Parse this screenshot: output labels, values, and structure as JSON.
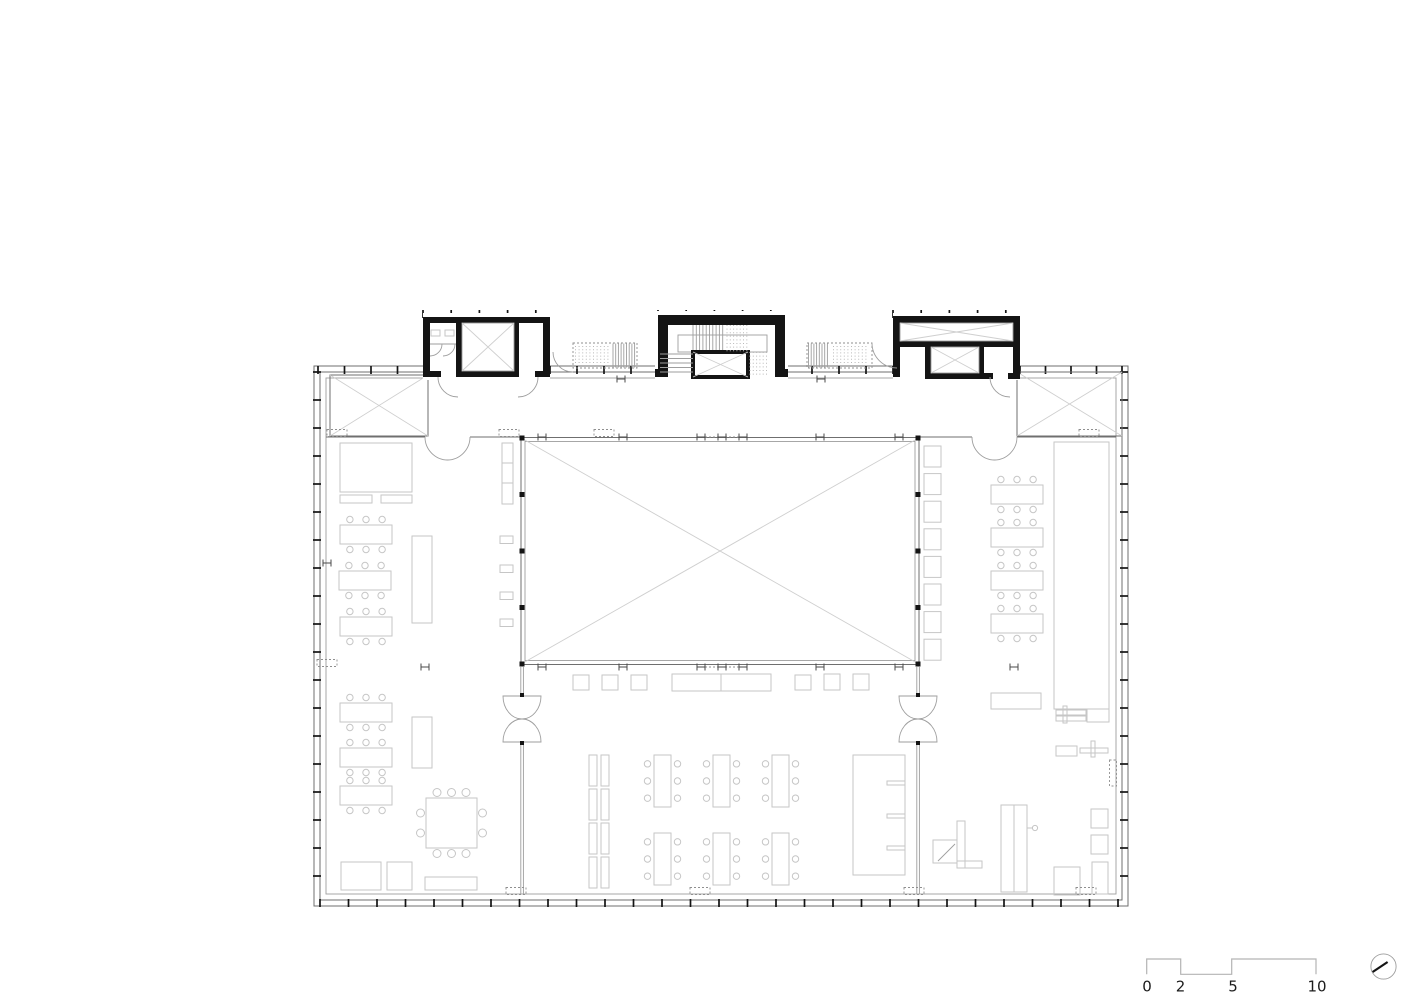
{
  "drawing": {
    "kind": "architectural floor plan",
    "colors": {
      "black": "#141414",
      "wall_line": "#6f6f6f",
      "thin_line": "#9e9e9e",
      "furniture_line": "#c6c6c6",
      "scale_bar_line": "#b4b4b4",
      "text": "#1c1c1c",
      "background": "#ffffff"
    }
  },
  "scale_bar": {
    "labels": [
      "0",
      "2",
      "5",
      "10"
    ]
  },
  "north_arrow": {
    "icon": "north-arrow-icon"
  },
  "plan": {
    "ticks": [
      {
        "axis": "x",
        "at": 314,
        "from": 423,
        "to": 550,
        "step": 28.2
      },
      {
        "axis": "x",
        "at": 314,
        "from": 658,
        "to": 785,
        "step": 28.2
      },
      {
        "axis": "x",
        "at": 314,
        "from": 893,
        "to": 1020,
        "step": 28.2
      },
      {
        "axis": "x",
        "at": 370,
        "from": 318,
        "to": 423,
        "step": 26.5
      },
      {
        "axis": "x",
        "at": 370,
        "from": 550,
        "to": 658,
        "step": 27
      },
      {
        "axis": "x",
        "at": 370,
        "from": 785,
        "to": 893,
        "step": 27
      },
      {
        "axis": "x",
        "at": 370,
        "from": 1020,
        "to": 1122,
        "step": 25.5
      },
      {
        "axis": "x",
        "at": 903,
        "from": 320,
        "to": 1122,
        "step": 28.5
      },
      {
        "axis": "y",
        "at": 317,
        "from": 372,
        "to": 900,
        "step": 28
      },
      {
        "axis": "y",
        "at": 1124,
        "from": 372,
        "to": 900,
        "step": 28
      }
    ],
    "table_size": [
      52,
      19
    ],
    "chair_r": 3.2,
    "tables": [
      [
        340,
        525
      ],
      [
        339,
        571
      ],
      [
        340,
        617
      ],
      [
        340,
        703
      ],
      [
        340,
        748
      ],
      [
        340,
        786
      ],
      [
        991,
        485
      ],
      [
        991,
        528
      ],
      [
        991,
        571
      ],
      [
        991,
        614
      ]
    ],
    "desk_size": [
      17,
      52
    ],
    "desks": [
      [
        654,
        755
      ],
      [
        713,
        755
      ],
      [
        772,
        755
      ],
      [
        654,
        833
      ],
      [
        713,
        833
      ],
      [
        772,
        833
      ]
    ],
    "lockers": {
      "x": 924,
      "y": 446,
      "w": 17,
      "h": 21,
      "count": 8,
      "step": 27.6
    },
    "wall_shelves": [
      [
        500,
        536
      ],
      [
        500,
        565
      ],
      [
        500,
        592
      ],
      [
        500,
        619
      ]
    ],
    "shelf_size": [
      13,
      7.5
    ],
    "partitions": [
      [
        589,
        755
      ],
      [
        589,
        789
      ],
      [
        589,
        823
      ],
      [
        589,
        857
      ]
    ],
    "atrium_columns": {
      "xs": [
        522,
        918
      ],
      "ys": [
        438,
        494.5,
        551,
        607.5,
        664
      ],
      "size": 5
    },
    "door_posts": [
      [
        522,
        695
      ],
      [
        522,
        743
      ],
      [
        918,
        695
      ],
      [
        918,
        743
      ]
    ],
    "h_markers": [
      [
        542,
        437
      ],
      [
        623,
        437
      ],
      [
        701,
        437
      ],
      [
        722,
        437
      ],
      [
        743,
        437
      ],
      [
        820,
        437
      ],
      [
        899,
        437
      ],
      [
        542,
        667
      ],
      [
        623,
        667
      ],
      [
        701,
        667
      ],
      [
        722,
        667
      ],
      [
        743,
        667
      ],
      [
        820,
        667
      ],
      [
        899,
        667
      ],
      [
        425,
        667
      ],
      [
        1014,
        667
      ],
      [
        621,
        379
      ],
      [
        821,
        379
      ],
      [
        327,
        563
      ]
    ],
    "dash_markers": [
      [
        337,
        433,
        "h"
      ],
      [
        509,
        433,
        "h"
      ],
      [
        604,
        433,
        "h"
      ],
      [
        1089,
        433,
        "h"
      ],
      [
        327,
        663,
        "h"
      ],
      [
        516,
        891,
        "h"
      ],
      [
        700,
        891,
        "h"
      ],
      [
        914,
        891,
        "h"
      ],
      [
        1086,
        891,
        "h"
      ],
      [
        1113,
        773,
        "v"
      ]
    ],
    "vlines": [
      {
        "x1": 693,
        "x2": 723,
        "step": 3.3,
        "y1": 325,
        "y2": 350
      },
      {
        "x1": 613,
        "x2": 636,
        "step": 2.7,
        "y1": 343.5,
        "y2": 367.5
      },
      {
        "x1": 808.5,
        "x2": 830,
        "step": 2.7,
        "y1": 343.5,
        "y2": 367.5
      },
      {
        "x1": 727,
        "x2": 747,
        "step": 3.3,
        "y1": 325,
        "y2": 352,
        "dot": 1
      },
      {
        "x1": 750,
        "x2": 768,
        "step": 3.3,
        "y1": 352,
        "y2": 376,
        "dot": 1
      }
    ],
    "hlines": [
      {
        "y1": 354,
        "y2": 372,
        "step": 4.5,
        "x1": 660,
        "x2": 693
      },
      {
        "y1": 346.5,
        "y2": 365,
        "step": 3.2,
        "x1": 575,
        "x2": 611,
        "dot": 1
      },
      {
        "y1": 346.5,
        "y2": 365,
        "step": 3.2,
        "x1": 833,
        "x2": 869,
        "dot": 1
      }
    ]
  }
}
